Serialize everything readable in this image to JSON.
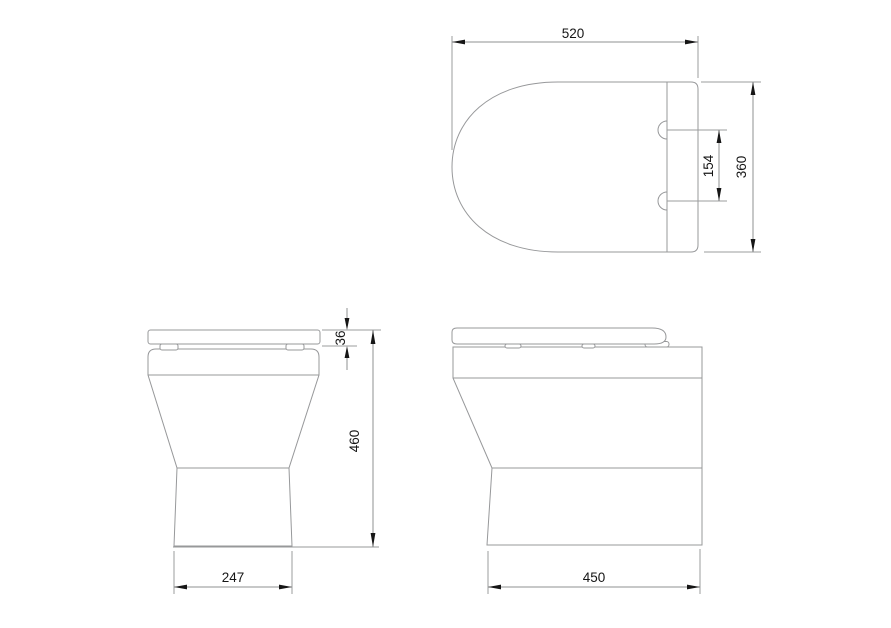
{
  "dimensions": {
    "top_width": "520",
    "hinge_centers": "154",
    "top_depth": "360",
    "lid_thickness": "36",
    "overall_height": "460",
    "base_width": "247",
    "base_depth": "450"
  },
  "colors": {
    "background": "#ffffff",
    "outline_gray": "#97989a",
    "dimension_text_black": "#161616"
  }
}
